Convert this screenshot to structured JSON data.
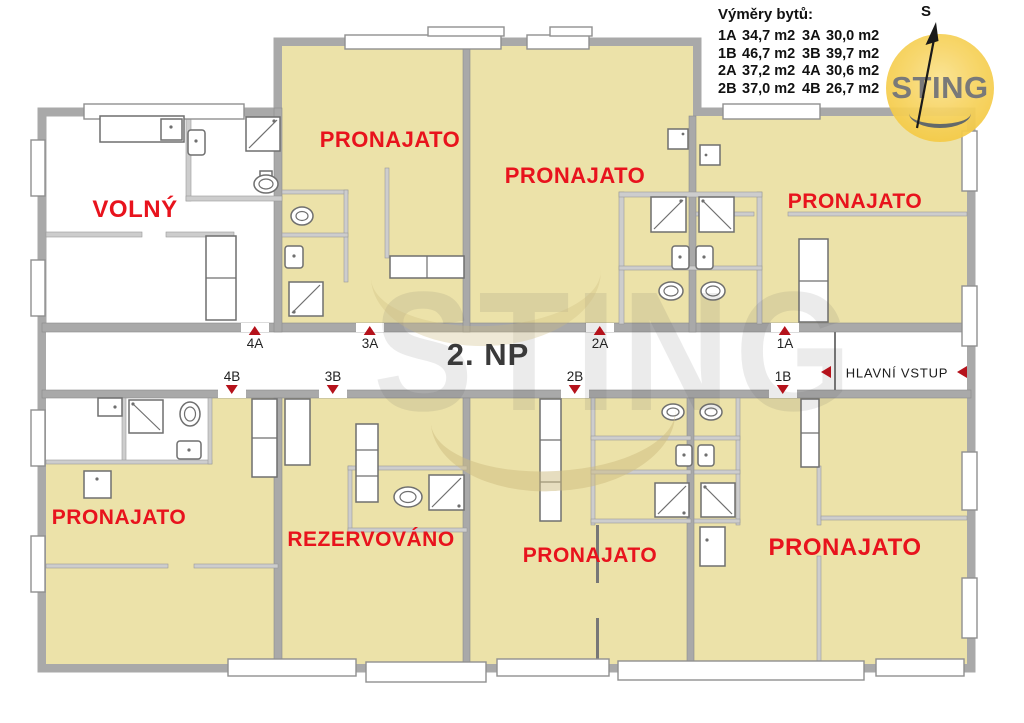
{
  "legend": {
    "title": "Výměry bytů:",
    "rows": [
      [
        "1A",
        "34,7 m2",
        "3A",
        "30,0 m2"
      ],
      [
        "1B",
        "46,7 m2",
        "3B",
        "39,7 m2"
      ],
      [
        "2A",
        "37,2 m2",
        "4A",
        "30,6 m2"
      ],
      [
        "2B",
        "37,0 m2",
        "4B",
        "26,7 m2"
      ]
    ]
  },
  "logo": {
    "text": "STING"
  },
  "north_label": "S",
  "watermark": {
    "text": "STING"
  },
  "floor": {
    "label": "2. NP",
    "entrance_label": "HLAVNÍ VSTUP"
  },
  "units": {
    "top": [
      {
        "id": "4A",
        "x": 255
      },
      {
        "id": "3A",
        "x": 370
      },
      {
        "id": "2A",
        "x": 600
      },
      {
        "id": "1A",
        "x": 785
      }
    ],
    "bottom": [
      {
        "id": "4B",
        "x": 232
      },
      {
        "id": "3B",
        "x": 333
      },
      {
        "id": "2B",
        "x": 575
      },
      {
        "id": "1B",
        "x": 783
      }
    ]
  },
  "statuses": [
    {
      "unit": "4A",
      "label": "VOLNÝ",
      "x": 135,
      "y": 210,
      "size": 24
    },
    {
      "unit": "3A",
      "label": "PRONAJATO",
      "x": 390,
      "y": 140,
      "size": 22
    },
    {
      "unit": "2A",
      "label": "PRONAJATO",
      "x": 575,
      "y": 176,
      "size": 22
    },
    {
      "unit": "1A",
      "label": "PRONAJATO",
      "x": 855,
      "y": 202,
      "size": 21
    },
    {
      "unit": "4B",
      "label": "PRONAJATO",
      "x": 119,
      "y": 518,
      "size": 21
    },
    {
      "unit": "3B",
      "label": "REZERVOVÁNO",
      "x": 371,
      "y": 540,
      "size": 21
    },
    {
      "unit": "2B",
      "label": "PRONAJATO",
      "x": 590,
      "y": 556,
      "size": 21
    },
    {
      "unit": "1B",
      "label": "PRONAJATO",
      "x": 845,
      "y": 548,
      "size": 24
    }
  ],
  "colors": {
    "occupied_fill": "#ece2a9",
    "available_fill": "#ffffff",
    "status_text": "#e8131d",
    "wall": "#a9a9a9",
    "marker_red": "#b5121b",
    "logo_yellow": "#f3c433",
    "floor_label_text": "#3a3a3a"
  }
}
